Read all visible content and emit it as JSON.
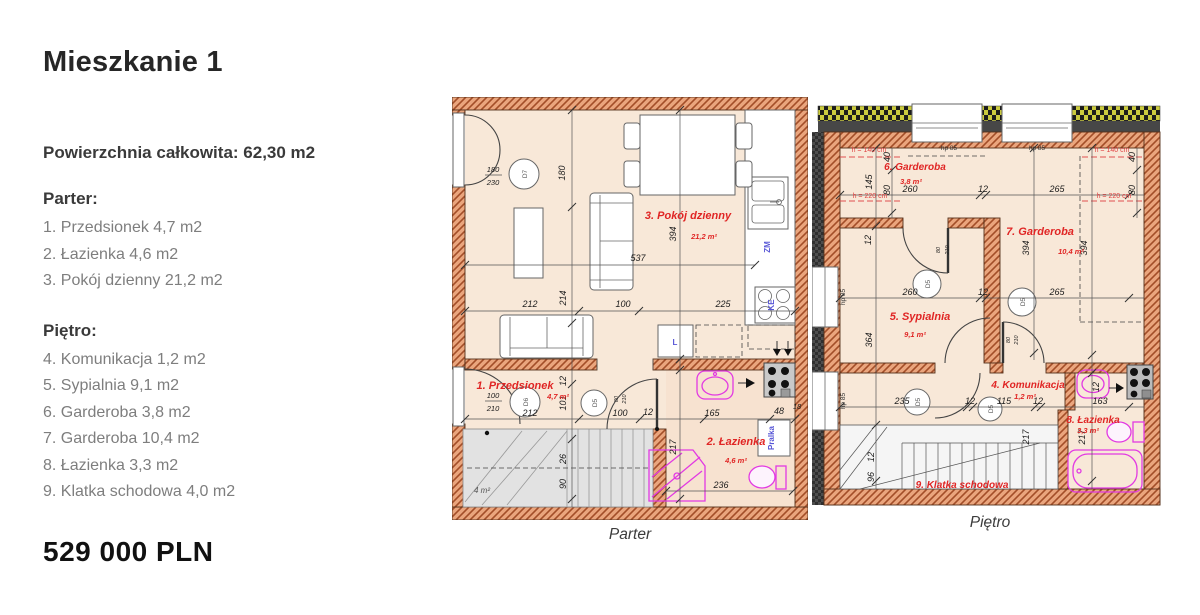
{
  "sidebar": {
    "title": "Mieszkanie 1",
    "total_area": "Powierzchnia całkowita: 62,30 m2",
    "floor_sections": [
      {
        "header": "Parter:",
        "items": [
          "1. Przedsionek 4,7 m2",
          "2. Łazienka 4,6 m2",
          "3. Pokój dzienny 21,2 m2"
        ]
      },
      {
        "header": "Piętro:",
        "items": [
          "4. Komunikacja 1,2 m2",
          "5. Sypialnia 9,1 m2",
          "6. Garderoba 3,8 m2",
          "7. Garderoba 10,4 m2",
          "8. Łazienka 3,3 m2",
          "9. Klatka schodowa 4,0 m2"
        ]
      }
    ],
    "price": "529 000 PLN"
  },
  "plans": {
    "colors": {
      "wall_fill": "#eaa57d",
      "wall_hatch": "#a34e28",
      "floor": "#f8e8d8",
      "fixture_magenta": "#e23ae2",
      "room_label_red": "#e02524",
      "blue_label": "#5857d6",
      "insulation_yellow": "#caca3e"
    },
    "parter": {
      "caption": "Parter",
      "rooms": {
        "przedsionek": {
          "name": "1. Przedsionek",
          "area": "4,7 m²"
        },
        "lazienka": {
          "name": "2. Łazienka",
          "area": "4,6 m²"
        },
        "pokoj": {
          "name": "3. Pokój dzienny",
          "area": "21,2 m²"
        }
      },
      "stairs_area": "4 m²",
      "doors": {
        "d7": "D7",
        "d6": "D6",
        "d5": "D5"
      },
      "door_dims": {
        "w180": "180",
        "h230": "230",
        "w100": "100",
        "h210": "210",
        "w80": "80"
      },
      "fixtures": {
        "zm": "ZM",
        "ke": "KE",
        "l": "L",
        "pralka": "Pralka"
      },
      "dims": {
        "d180": "180",
        "d394": "394",
        "d537": "537",
        "d212": "212",
        "d214": "214",
        "d100": "100",
        "d225": "225",
        "d12": "12",
        "d101": "101",
        "d165": "165",
        "d48": "48",
        "d18": "18",
        "d217": "217",
        "d236": "236",
        "d26": "26",
        "d90": "90"
      }
    },
    "pietro": {
      "caption": "Piętro",
      "rooms": {
        "komunikacja": {
          "name": "4. Komunikacja",
          "area": "1,2 m²"
        },
        "sypialnia": {
          "name": "5. Sypialnia",
          "area": "9,1 m²"
        },
        "garderoba6": {
          "name": "6. Garderoba",
          "area": "3,8 m²"
        },
        "garderoba7": {
          "name": "7. Garderoba",
          "area": "10,4 m²"
        },
        "lazienka8": {
          "name": "8. Łazienka",
          "area": "3,3 m²"
        },
        "klatka": {
          "name": "9. Klatka schodowa"
        }
      },
      "annotations": {
        "h140": "h = 140 cm",
        "h220": "h = 220 cm",
        "hp85": "hp 85"
      },
      "door_label": "D5",
      "door_dims": {
        "w80": "80",
        "h210": "210"
      },
      "dims": {
        "d145": "145",
        "d40": "40",
        "d80": "80",
        "d260": "260",
        "d12": "12",
        "d265": "265",
        "d394": "394",
        "d364": "364",
        "d235": "235",
        "d115": "115",
        "d163": "163",
        "d217": "217",
        "d96": "96"
      }
    }
  }
}
